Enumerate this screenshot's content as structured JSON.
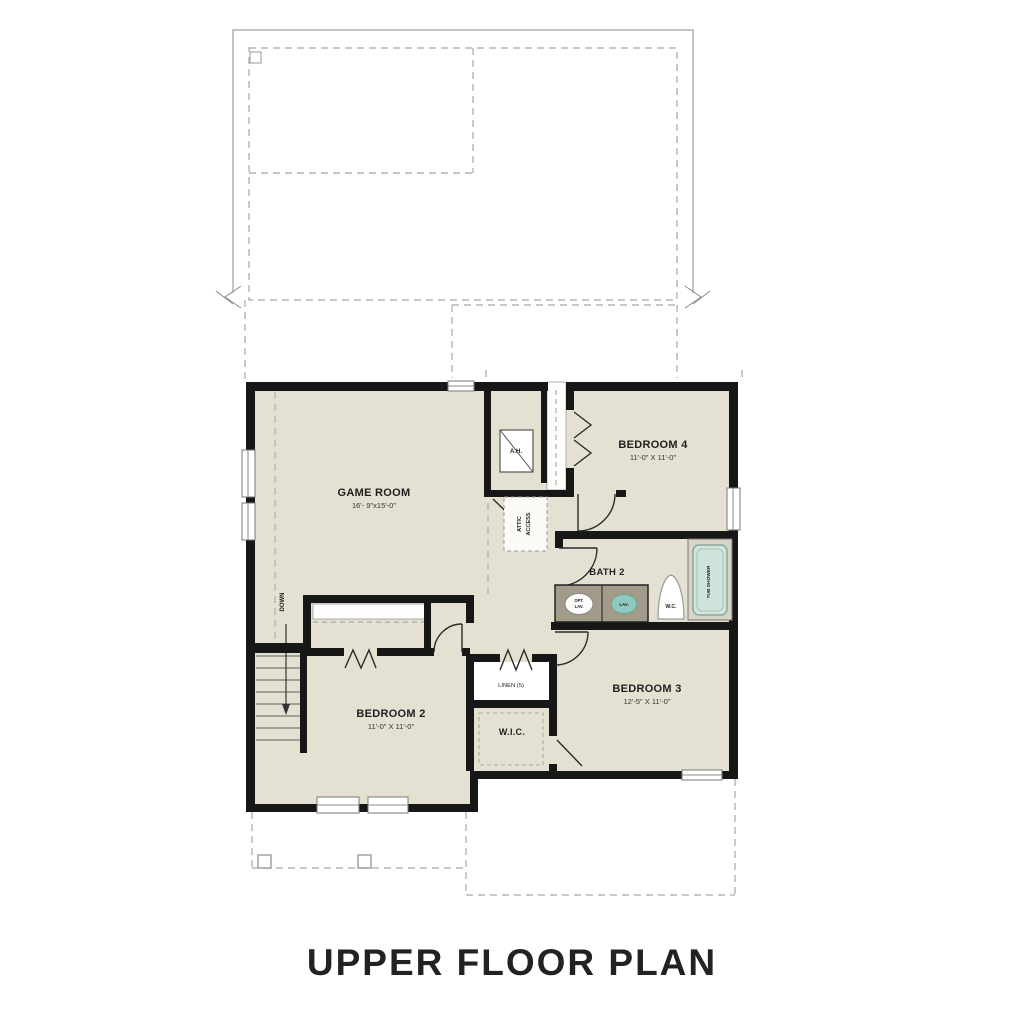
{
  "title": "UPPER FLOOR PLAN",
  "rooms": {
    "game_room": {
      "name": "GAME ROOM",
      "dims": "16'- 9\"x15'-0\""
    },
    "bedroom4": {
      "name": "BEDROOM 4",
      "dims": "11'-0\" X 11'-0\""
    },
    "bedroom3": {
      "name": "BEDROOM 3",
      "dims": "12'-5\" X 11'-0\""
    },
    "bedroom2": {
      "name": "BEDROOM 2",
      "dims": "11'-0\" X 11'-0\""
    },
    "bath2": {
      "name": "BATH 2"
    },
    "wic": {
      "name": "W.I.C."
    },
    "linen": {
      "name": "LINEN (5)"
    }
  },
  "fixtures": {
    "tub": "TUB SHOWER",
    "wc": "W.C.",
    "lav": "LAV.",
    "opt_lav_line1": "OPT.",
    "opt_lav_line2": "LAV.",
    "ah": "A.H.",
    "attic_line1": "ATTIC",
    "attic_line2": "ACCESS",
    "down": "DOWN"
  },
  "colors": {
    "floor": "#e4e0d2",
    "wall": "#171717",
    "tub_fill": "#cfe4db",
    "tub_stroke": "#8aa89c",
    "sink_teal": "#8fc9bf",
    "vanity": "#a39b8a",
    "construction_dash": "#b5b5b5"
  }
}
